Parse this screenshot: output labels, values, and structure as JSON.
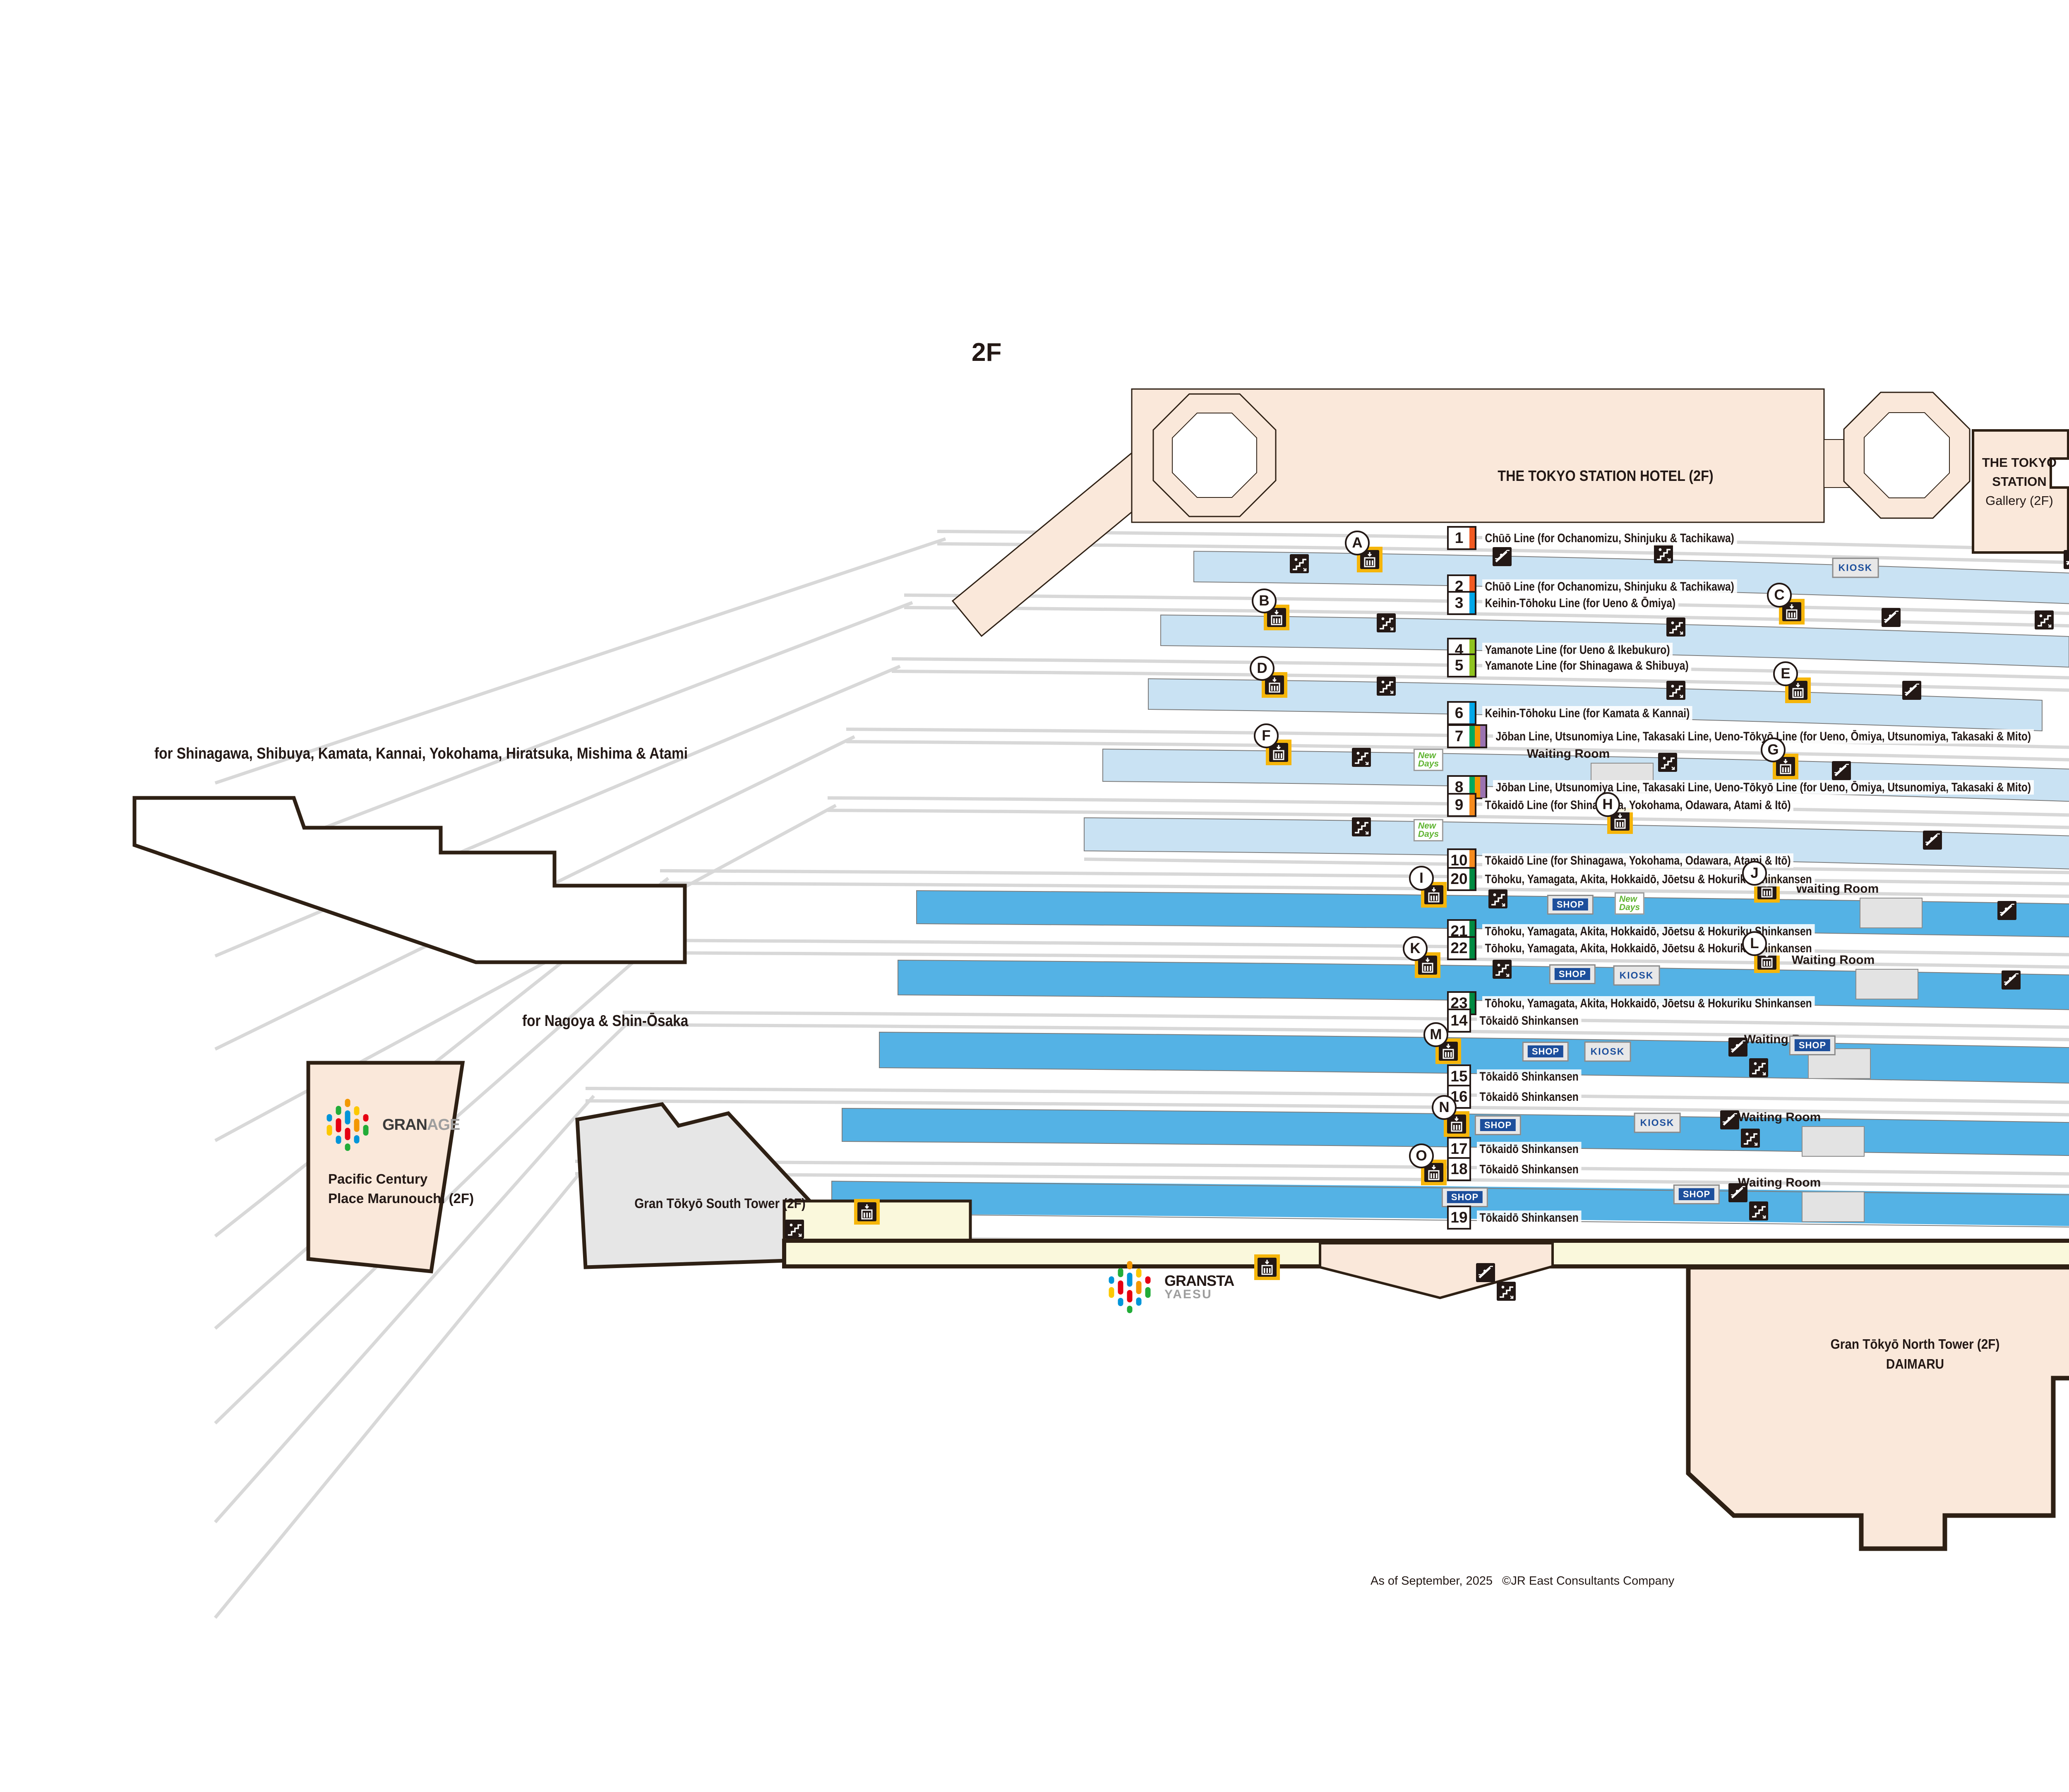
{
  "floor_label": "2F",
  "colors": {
    "platform_conventional": "#C9E2F3",
    "platform_shinkansen": "#54B2E5",
    "track": "#D8D8D8",
    "building_pink": "#FAE8DA",
    "building_gray": "#E6E6E6",
    "gransta_yellow": "#FAF8DC",
    "outline_dark": "#2E2014",
    "icon_black": "#231815",
    "elevator_yellow": "#F5B50A",
    "shop_blue": "#1D4F9C",
    "chuo_orange": "#F15A22",
    "keihin_blue": "#00A7E8",
    "yamanote_green": "#8FC31F",
    "joban_green": "#00A95F",
    "takasaki_orange": "#F39700",
    "ueno_tokyo_purple": "#9B72B0",
    "tokaido_orange": "#F68B1E",
    "tohoku_shinkansen_green": "#008A41"
  },
  "directions": {
    "northeast_line1": "for Ochanomizu, Shinjuku,",
    "northeast_line2": "Tachikawa, Ueno, Ōmiya & Ikebukuro",
    "southwest": "for Shinagawa, Shibuya, Kamata, Kannai, Yokohama, Hiratsuka, Mishima & Atami",
    "tokaido_shinkansen": "for Nagoya & Shin-Ōsaka",
    "tohoku_shinkansen": "for Ueno"
  },
  "mezzanine_label": "M2F",
  "buildings": {
    "hotel": "THE TOKYO STATION HOTEL (2F)",
    "gallery_line1": "THE TOKYO",
    "gallery_line2": "STATION",
    "gallery_line3": "Gallery (2F)",
    "sapia": "Sapia Tower",
    "pcp_line1": "Pacific Century",
    "pcp_line2": "Place Marunouchi (2F)",
    "south_tower": "Gran Tōkyō South Tower (2F)",
    "north_tower_line1": "Gran Tōkyō North Tower (2F)",
    "north_tower_line2": "DAIMARU"
  },
  "logos": {
    "granage_black": "GRAN",
    "granage_gray": "AGE",
    "gransta_black": "GRANSTA",
    "gransta_gray": "YAESU",
    "palette": [
      "#E60012",
      "#F39700",
      "#FCC800",
      "#22AC38",
      "#0095D9"
    ]
  },
  "facilities": {
    "waiting_room": "Waiting Room",
    "shop": "SHOP",
    "kiosk": "KIOSK",
    "newdays_line1": "New",
    "newdays_line2": "Days"
  },
  "elevator_letters": [
    "A",
    "B",
    "C",
    "D",
    "E",
    "F",
    "G",
    "H",
    "I",
    "J",
    "K",
    "L",
    "M",
    "N",
    "O"
  ],
  "platforms": [
    {
      "num": "1",
      "label": "Chūō Line (for Ochanomizu, Shinjuku & Tachikawa)",
      "stripes": [
        "#F15A22"
      ]
    },
    {
      "num": "2",
      "label": "Chūō Line (for Ochanomizu, Shinjuku & Tachikawa)",
      "stripes": [
        "#F15A22"
      ]
    },
    {
      "num": "3",
      "label": "Keihin-Tōhoku Line (for Ueno & Ōmiya)",
      "stripes": [
        "#00A7E8"
      ]
    },
    {
      "num": "4",
      "label": "Yamanote Line (for Ueno & Ikebukuro)",
      "stripes": [
        "#8FC31F"
      ]
    },
    {
      "num": "5",
      "label": "Yamanote Line (for Shinagawa & Shibuya)",
      "stripes": [
        "#8FC31F"
      ]
    },
    {
      "num": "6",
      "label": "Keihin-Tōhoku Line (for Kamata & Kannai)",
      "stripes": [
        "#00A7E8"
      ]
    },
    {
      "num": "7",
      "label": "Jōban Line, Utsunomiya Line, Takasaki Line, Ueno-Tōkyō Line (for Ueno, Ōmiya, Utsunomiya, Takasaki & Mito)",
      "stripes": [
        "#00A95F",
        "#F39700",
        "#9B72B0"
      ]
    },
    {
      "num": "8",
      "label": "Jōban Line, Utsunomiya Line, Takasaki Line, Ueno-Tōkyō Line (for Ueno, Ōmiya, Utsunomiya, Takasaki & Mito)",
      "stripes": [
        "#00A95F",
        "#F39700",
        "#9B72B0"
      ]
    },
    {
      "num": "9",
      "label": "Tōkaidō Line (for Shinagawa, Yokohama, Odawara, Atami & Itō)",
      "stripes": [
        "#F68B1E"
      ]
    },
    {
      "num": "10",
      "label": "Tōkaidō Line (for Shinagawa, Yokohama, Odawara, Atami & Itō)",
      "stripes": [
        "#F68B1E"
      ]
    },
    {
      "num": "20",
      "label": "Tōhoku, Yamagata, Akita, Hokkaidō, Jōetsu & Hokuriku Shinkansen",
      "stripes": [
        "#008A41"
      ]
    },
    {
      "num": "21",
      "label": "Tōhoku, Yamagata, Akita, Hokkaidō, Jōetsu & Hokuriku Shinkansen",
      "stripes": [
        "#008A41"
      ]
    },
    {
      "num": "22",
      "label": "Tōhoku, Yamagata, Akita, Hokkaidō, Jōetsu & Hokuriku Shinkansen",
      "stripes": [
        "#008A41"
      ]
    },
    {
      "num": "23",
      "label": "Tōhoku, Yamagata, Akita, Hokkaidō, Jōetsu & Hokuriku Shinkansen",
      "stripes": [
        "#008A41"
      ]
    },
    {
      "num": "14",
      "label": "Tōkaidō Shinkansen",
      "stripes": []
    },
    {
      "num": "15",
      "label": "Tōkaidō Shinkansen",
      "stripes": []
    },
    {
      "num": "16",
      "label": "Tōkaidō Shinkansen",
      "stripes": []
    },
    {
      "num": "17",
      "label": "Tōkaidō Shinkansen",
      "stripes": []
    },
    {
      "num": "18",
      "label": "Tōkaidō Shinkansen",
      "stripes": []
    },
    {
      "num": "19",
      "label": "Tōkaidō Shinkansen",
      "stripes": []
    }
  ],
  "footer": {
    "as_of": "As of September, 2025",
    "credit": "©JR East Consultants Company"
  }
}
